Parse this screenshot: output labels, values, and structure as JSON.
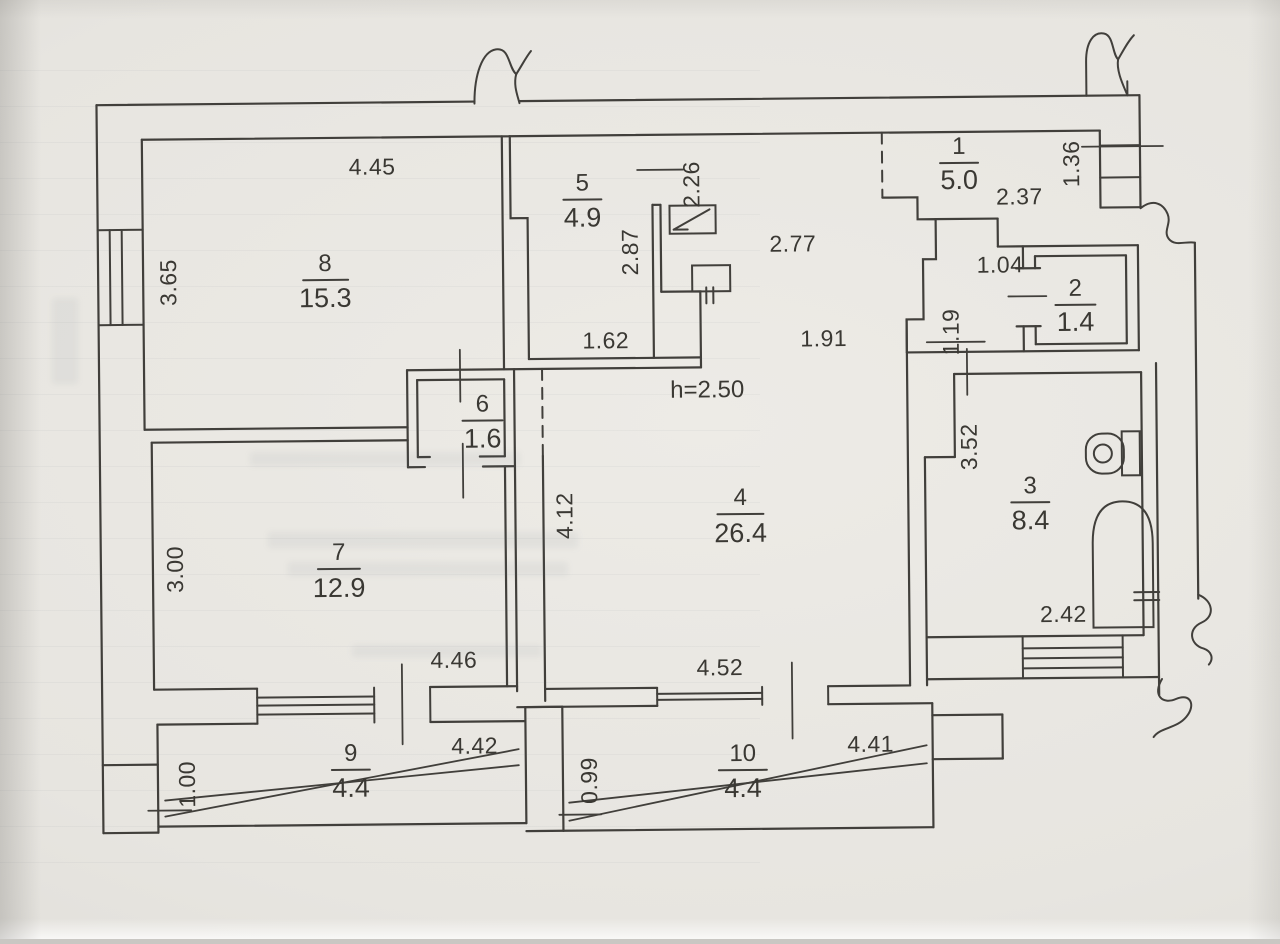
{
  "plan": {
    "type": "apartment-floor-plan",
    "ceiling_height_note": "h=2.50"
  },
  "rooms": {
    "r1": {
      "number": "1",
      "area": "5.0"
    },
    "r2": {
      "number": "2",
      "area": "1.4"
    },
    "r3": {
      "number": "3",
      "area": "8.4"
    },
    "r4": {
      "number": "4",
      "area": "26.4"
    },
    "r5": {
      "number": "5",
      "area": "4.9"
    },
    "r6": {
      "number": "6",
      "area": "1.6"
    },
    "r7": {
      "number": "7",
      "area": "12.9"
    },
    "r8": {
      "number": "8",
      "area": "15.3"
    },
    "r9": {
      "number": "9",
      "area": "4.4"
    },
    "r10": {
      "number": "10",
      "area": "4.4"
    }
  },
  "dims": {
    "room8_width": "4.45",
    "room8_depth": "3.65",
    "room5_depth": "2.87",
    "room5_width": "1.62",
    "opening_depth": "2.26",
    "hall_width_upper": "2.77",
    "hall_width_lower": "1.91",
    "room1_width": "2.37",
    "entry_window_width": "1.36",
    "niche_width": "1.04",
    "niche_depth": "1.19",
    "room3_depth": "3.52",
    "room3_width": "2.42",
    "room4_depth": "4.12",
    "room4_width": "4.52",
    "room7_depth": "3.00",
    "room7_width": "4.46",
    "balcony9_depth": "1.00",
    "balcony9_width": "4.42",
    "balcony10_depth": "0.99",
    "balcony10_width": "4.41"
  },
  "icons": {
    "electrical_panel": "electrical-panel",
    "meter_box": "meter-box",
    "toilet": "toilet",
    "bathtub": "bathtub",
    "wall_break": "wall-break",
    "window": "window",
    "balcony_railing": "balcony-railing"
  },
  "colors": {
    "ink": "#413f3b",
    "paper": "#e9e7e2"
  }
}
